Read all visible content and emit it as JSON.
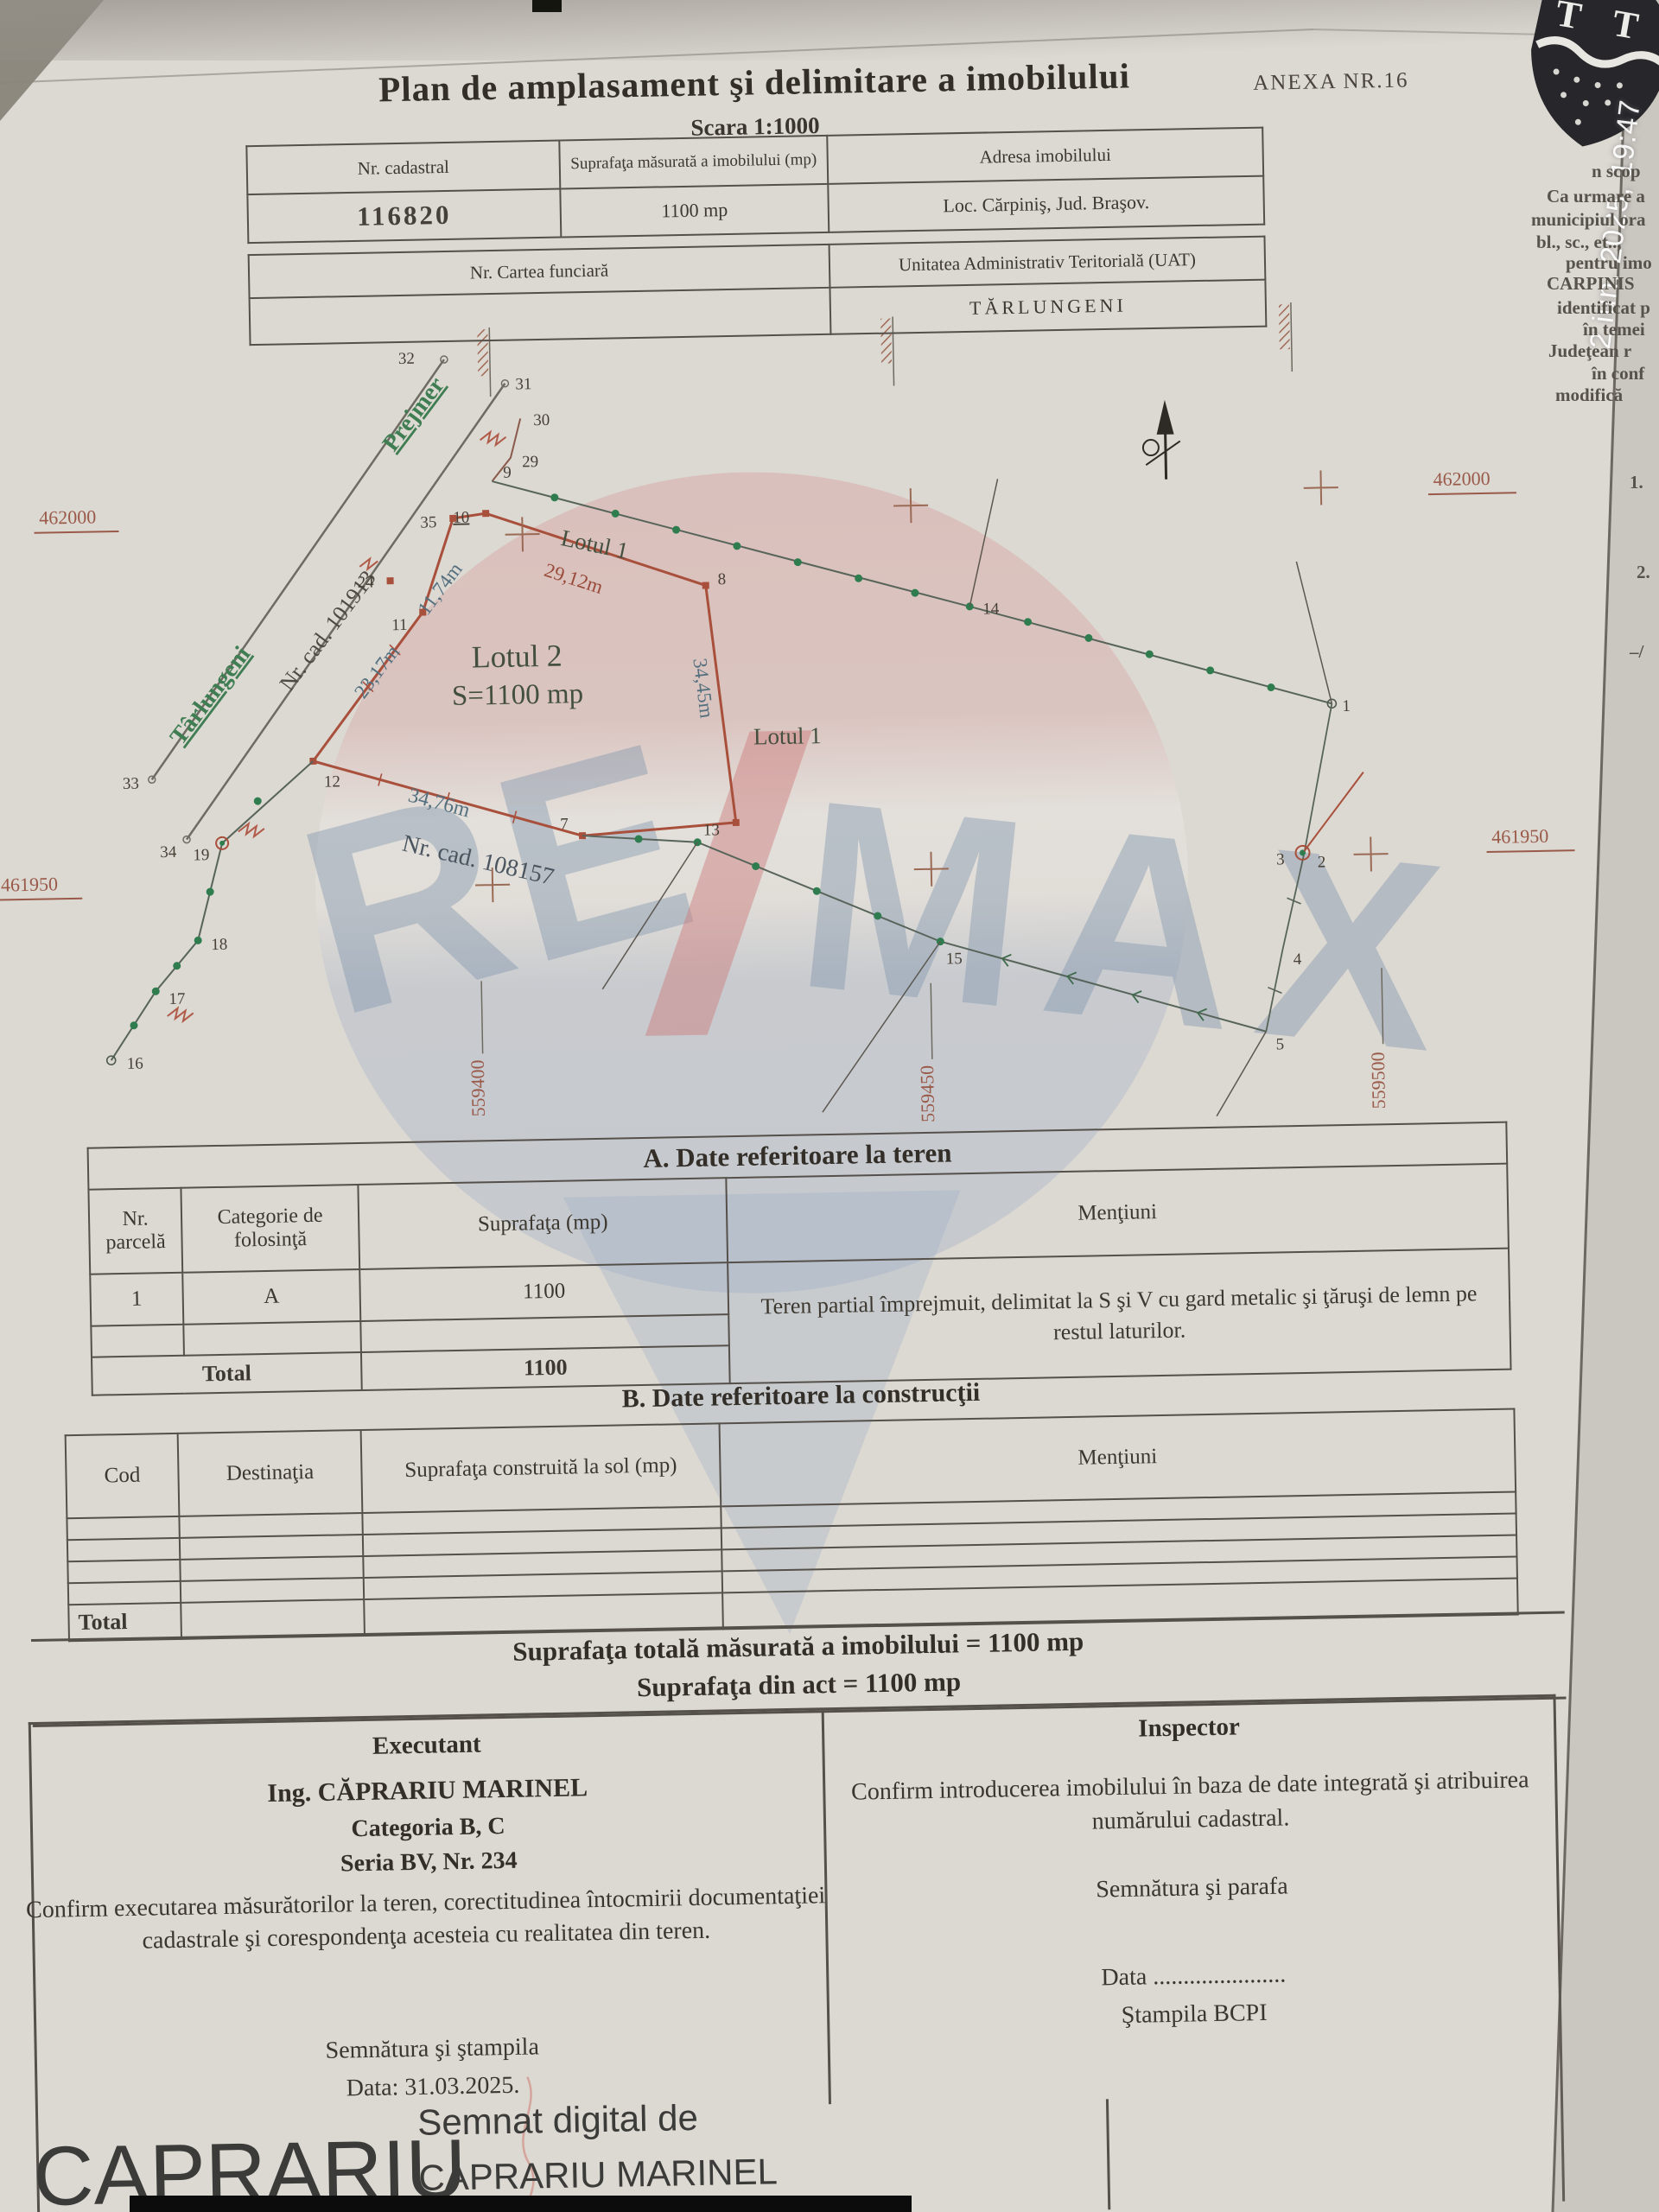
{
  "photo": {
    "timestamp": "2 iun. 2025, 19:47"
  },
  "doc": {
    "title": "Plan de amplasament şi delimitare a imobilului",
    "scale": "Scara 1:1000",
    "annex": "ANEXA NR.16"
  },
  "id_table": {
    "h_cadastral": "Nr. cadastral",
    "h_area": "Suprafaţa măsurată a imobilului (mp)",
    "h_address": "Adresa imobilului",
    "cadastral": "116820",
    "area": "1100 mp",
    "address": "Loc. Cărpiniş, Jud. Braşov.",
    "h_land_book": "Nr. Cartea funciară",
    "h_uat": "Unitatea Administrativ Teritorială (UAT)",
    "uat": "TĂRLUNGENI"
  },
  "watermark": {
    "re": "RE",
    "max": "MAX"
  },
  "map": {
    "roads": {
      "prejmer": "Prejmer",
      "tarlungeni": "Târlungeni"
    },
    "cadastral": {
      "c1": "Nr. cad. 101913",
      "c2": "Nr. cad. 108157"
    },
    "lots": {
      "lot1_a": "Lotul 1",
      "lot1_b": "Lotul 1",
      "lot2_name": "Lotul 2",
      "lot2_area": "S=1100 mp"
    },
    "measures": {
      "m29": "29,12m",
      "m3445": "34,45m",
      "m3476": "34,76m",
      "m2317": "23,17m",
      "m1174": "11,74m"
    },
    "grid": {
      "x462000": "462000",
      "x461950": "461950",
      "y559400": "559400",
      "y559450": "559450",
      "y559500": "559500"
    },
    "points": {
      "p1": "1",
      "p2": "2",
      "p3": "3",
      "p4": "4",
      "p5": "5",
      "p7": "7",
      "p8": "8",
      "p9": "9",
      "p10": "10",
      "p11": "11",
      "p12": "12",
      "p13": "13",
      "p14": "14",
      "p15": "15",
      "p16": "16",
      "p17": "17",
      "p18": "18",
      "p19": "19",
      "p24": "24",
      "p29": "29",
      "p30": "30",
      "p31": "31",
      "p32": "32",
      "p33": "33",
      "p34": "34",
      "p35": "35"
    }
  },
  "table_a": {
    "title": "A. Date referitoare la teren",
    "h_parcel": "Nr. parcelă",
    "h_category": "Categorie de folosinţă",
    "h_area": "Suprafaţa (mp)",
    "h_mentions": "Menţiuni",
    "parcel": "1",
    "category": "A",
    "area": "1100",
    "mentions": "Teren partial împrejmuit, delimitat la S şi V cu gard metalic şi ţăruşi de lemn pe restul laturilor.",
    "total_label": "Total",
    "total_area": "1100"
  },
  "table_b": {
    "title": "B. Date referitoare la construcţii",
    "h_code": "Cod",
    "h_destination": "Destinaţia",
    "h_area": "Suprafaţa construită la sol (mp)",
    "h_mentions": "Menţiuni",
    "total_label": "Total"
  },
  "summary": {
    "measured": "Suprafaţa totală măsurată a imobilului = 1100 mp",
    "act": "Suprafaţa din act = 1100 mp"
  },
  "executant": {
    "label": "Executant",
    "name": "Ing. CĂPRARIU MARINEL",
    "category": "Categoria B, C",
    "series": "Seria BV, Nr. 234",
    "statement": "Confirm executarea măsurătorilor la teren, corectitudinea întocmirii documentaţiei cadastrale şi corespondenţa acesteia cu realitatea din teren.",
    "signature": "Semnătura şi ştampila",
    "date": "Data: 31.03.2025."
  },
  "inspector": {
    "label": "Inspector",
    "statement": "Confirm introducerea imobilului în baza de date integrată şi atribuirea numărului cadastral.",
    "signature": "Semnătura şi parafa",
    "date": "Data ......................",
    "stamp": "Ştampila BCPI"
  },
  "digital_signature": {
    "name_large": "CAPRARIU",
    "line1": "Semnat digital de",
    "line2": "CAPRARIU MARINEL"
  },
  "crest": {
    "letters": "T T"
  },
  "side_page": {
    "lines": [
      "n scop",
      "Ca urmare a",
      "municipiul ora",
      "bl., sc., et..,",
      "pentru imo",
      "CARPINIS",
      "identificat p",
      "în temei",
      "Judeţean r",
      "în conf",
      "modifică",
      "1.",
      "2.",
      "–/"
    ]
  }
}
